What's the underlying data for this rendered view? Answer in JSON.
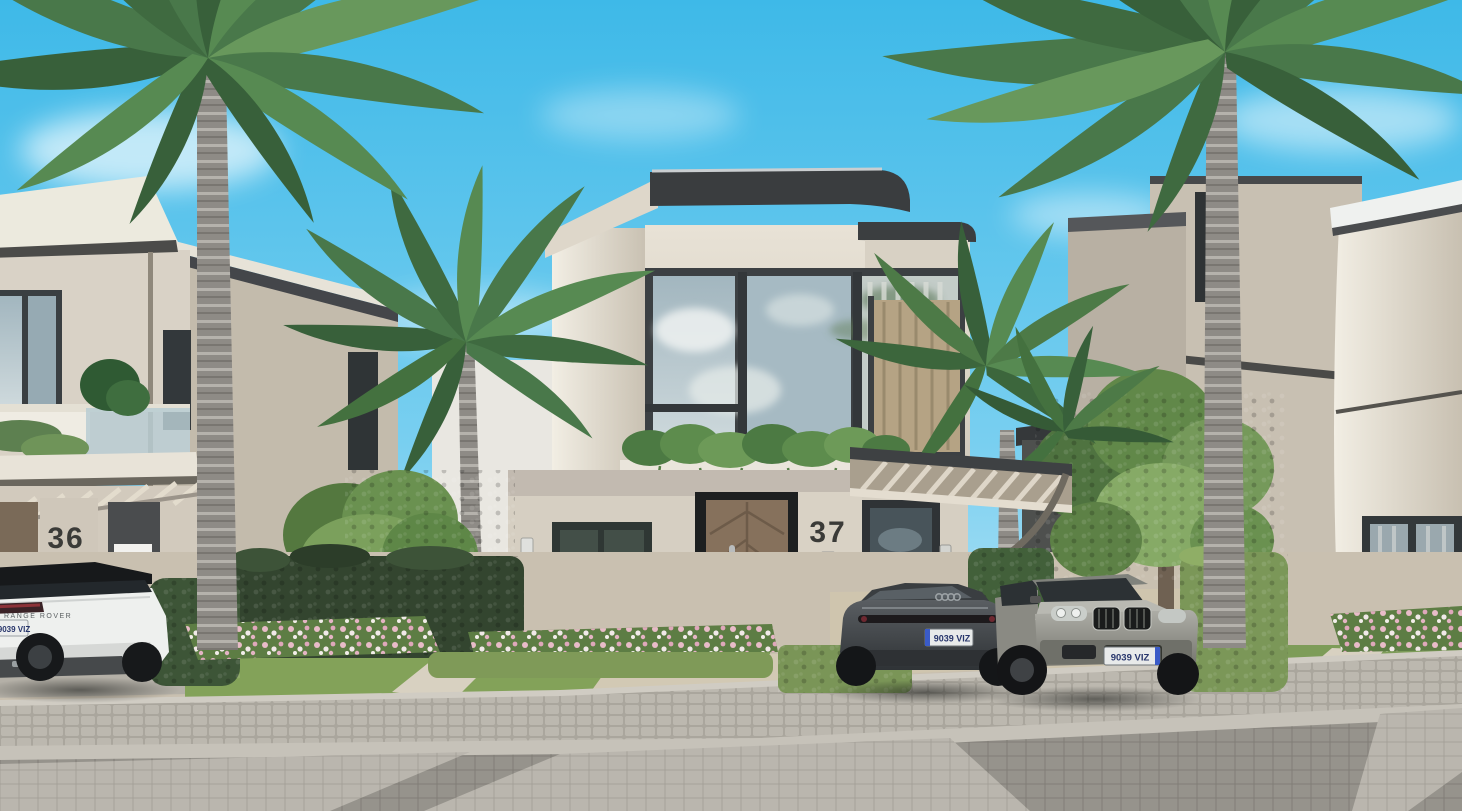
{
  "scene": {
    "title": "Street-view architectural render of modern villas with palms and parked cars",
    "palette": {
      "sky_top": "#3eb9e8",
      "sky_horizon": "#d8f0f9",
      "wall_beige": "#d6cfc2",
      "wall_shade": "#b9b1a3",
      "fascia_dark": "#3a3d3f",
      "glass": "#a9bcc4",
      "door_wood": "#86715c",
      "grass": "#83a259",
      "hedge_dark": "#33452f",
      "hedge_light": "#7b9758",
      "flower_pink": "#e4b4c4",
      "road_paver": "#93908a",
      "cobble": "#b6b2a9"
    }
  },
  "villas": {
    "left": {
      "number": "36"
    },
    "center": {
      "number": "37"
    }
  },
  "cars": [
    {
      "name": "white-range-rover",
      "badge": "RANGE ROVER",
      "plate": "9039 VIZ"
    },
    {
      "name": "dark-gray-sedan",
      "plate": "9039 VIZ"
    },
    {
      "name": "silver-suv",
      "plate": "9039 VIZ"
    }
  ]
}
